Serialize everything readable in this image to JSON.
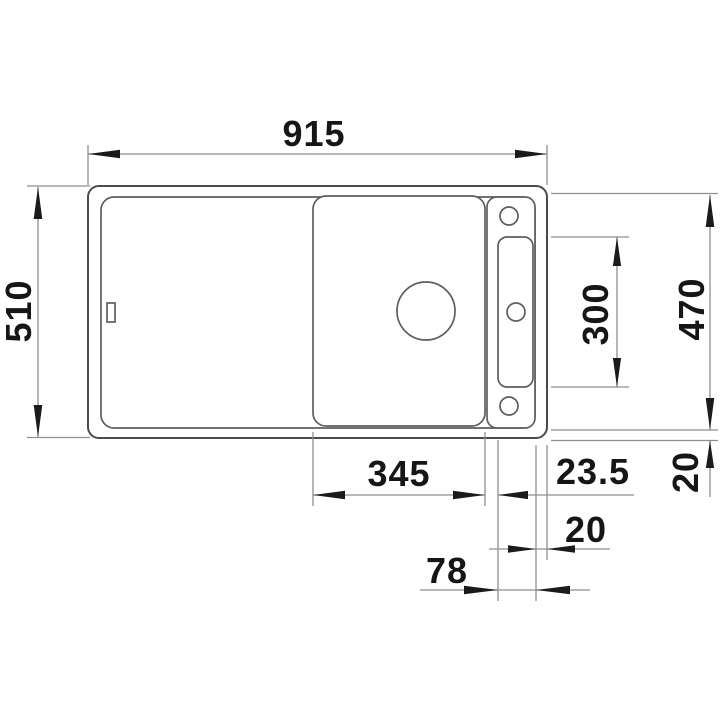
{
  "drawing": {
    "type": "sink-installation-dimension-drawing",
    "labels": {
      "total_width": "915",
      "total_depth": "510",
      "inner_depth": "470",
      "slot_length": "300",
      "board_width": "345",
      "board_slot_gap": "23.5",
      "rim_width_bottom": "20",
      "rim_width_right": "20",
      "rail_width": "78"
    },
    "colors": {
      "background": "#ffffff",
      "outline": "#4b4b4b",
      "dimension_line": "#8f8f8f",
      "text": "#161616"
    }
  }
}
